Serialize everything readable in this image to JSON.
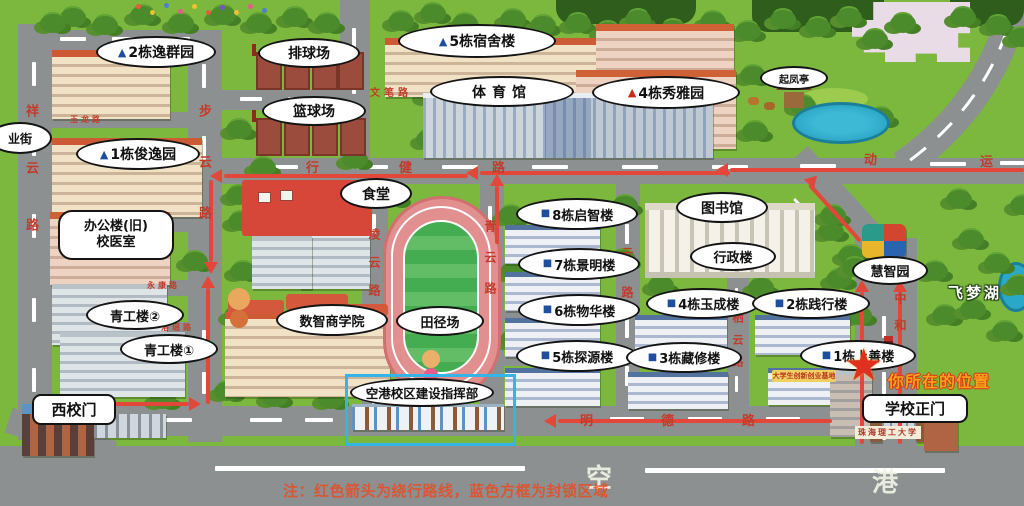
{
  "labels": {
    "dorm2": "2栋逸群园",
    "dorm1": "1栋俊逸园",
    "volleyball": "排球场",
    "basketball": "篮球场",
    "dorm5": "5栋宿舍楼",
    "gym": "体育馆",
    "qifeng_pavilion": "起凤亭",
    "dorm4": "4栋秀雅园",
    "canteen": "食堂",
    "office_old": "办公楼(旧)",
    "clinic": "校医室",
    "qinggong2": "青工楼②",
    "qinggong1": "青工楼①",
    "business_school": "数智商学院",
    "track_field": "田径场",
    "hq": "空港校区建设指挥部",
    "b8": "8栋启智楼",
    "b7": "7栋景明楼",
    "b6": "6栋物华楼",
    "b5": "5栋探源楼",
    "b4": "4栋玉成楼",
    "b3": "3栋藏修楼",
    "b2": "2栋践行楼",
    "b1": "1栋上善楼",
    "library": "图书馆",
    "admin": "行政楼",
    "huizhi_garden": "慧智园",
    "feimeng_lake": "飞梦湖",
    "west_gate": "西校门",
    "main_gate": "学校正门",
    "you_are_here": "你所在的位置",
    "innovation_base": "大学生创新创业基地",
    "gate_sign": "珠海理工大学",
    "street_partial": "业街"
  },
  "roads": {
    "xiangyun": "祥云路",
    "buyun": "步云路",
    "lingyun": "凌云路",
    "qingyun": "青云路",
    "ziyun": "紫云路",
    "qiyun": "栖云路",
    "zhonghe": "中和路",
    "xingjian": "行健路",
    "mingde": "明德路",
    "wenbi": "文笔路",
    "yulong": "玉龙路",
    "fuquan": "伏泉路",
    "yongkang": "永康路",
    "luoyao": "洛瑶路",
    "yundong_char1": "动",
    "yundong_char2": "运",
    "konggang_char1": "空",
    "konggang_char2": "港"
  },
  "markers": {
    "blue_triangle": "▲",
    "red_triangle": "▲",
    "blue_square": "■",
    "star": "★"
  },
  "note": "注：红色箭头为绕行路线，蓝色方框为封锁区域",
  "colors": {
    "route_red": "#e2473a",
    "closure_blue": "#35b4e8",
    "grass": "#7bb83d",
    "road": "#8d9090"
  }
}
